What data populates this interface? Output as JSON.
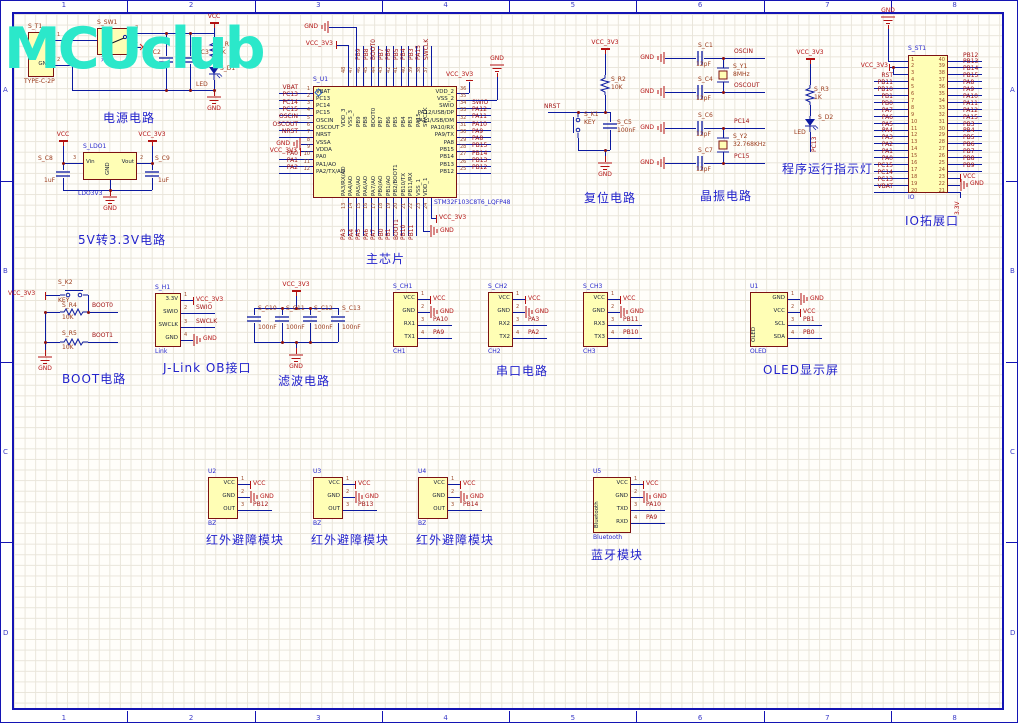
{
  "sheet": {
    "logo_text": "MCUclub",
    "zone_columns": [
      "1",
      "2",
      "3",
      "4",
      "5",
      "6",
      "7",
      "8"
    ],
    "zone_rows": [
      "A",
      "B",
      "C",
      "D"
    ]
  },
  "captions": {
    "power": "电源电路",
    "ldo": "5V转3.3V电路",
    "mcu": "主芯片",
    "reset": "复位电路",
    "crystal": "晶振电路",
    "led": "程序运行指示灯",
    "io": "IO拓展口",
    "boot": "BOOT电路",
    "jlink": "J-Link OB接口",
    "filter": "滤波电路",
    "serial": "串口电路",
    "oled": "OLED显示屏",
    "ir1": "红外避障模块",
    "ir2": "红外避障模块",
    "ir3": "红外避障模块",
    "bt": "蓝牙模块"
  },
  "power_nets": {
    "vcc": "VCC",
    "vcc3": "VCC_3V3",
    "gnd": "GND",
    "v33": "3.3V"
  },
  "net_labels": {
    "nrst": "NRST",
    "boot0": "BOOT0",
    "boot1": "BOOT1",
    "pc13": "PC13",
    "oscin": "OSCIN",
    "oscout": "OSCOUT",
    "pc14": "PC14",
    "pc15": "PC15"
  },
  "mcu": {
    "designator": "S_U1",
    "part": "STM32F103C8T6_LQFP48",
    "left": [
      [
        "1",
        "VBAT",
        "VBAT"
      ],
      [
        "2",
        "PC13",
        "PC13"
      ],
      [
        "3",
        "PC14",
        "PC14"
      ],
      [
        "4",
        "PC15",
        "PC15"
      ],
      [
        "5",
        "OSCIN",
        "OSCIN"
      ],
      [
        "6",
        "OSCOUT",
        "OSCOUT"
      ],
      [
        "7",
        "NRST",
        "NRST"
      ],
      [
        "8",
        "VSSA",
        "GND"
      ],
      [
        "9",
        "VDDA",
        "VCC_3V3"
      ],
      [
        "10",
        "PA0",
        "PA0"
      ],
      [
        "11",
        "PA1/AO",
        "PA1"
      ],
      [
        "12",
        "PA2/TX/AO",
        "PA2"
      ]
    ],
    "right": [
      [
        "36",
        "VDD_2",
        ""
      ],
      [
        "35",
        "VSS_2",
        ""
      ],
      [
        "34",
        "SWIO",
        "SWIO"
      ],
      [
        "33",
        "PA12/USB/DP",
        "PA12"
      ],
      [
        "32",
        "PA11/USB/DM",
        "PA11"
      ],
      [
        "31",
        "PA10/RX",
        "PA10"
      ],
      [
        "30",
        "PA9/TX",
        "PA9"
      ],
      [
        "29",
        "PA8",
        "PA8"
      ],
      [
        "28",
        "PB15",
        "PB15"
      ],
      [
        "27",
        "PB14",
        "PB14"
      ],
      [
        "26",
        "PB13",
        "PB13"
      ],
      [
        "25",
        "PB12",
        "PB12"
      ]
    ],
    "top": [
      [
        "48",
        "VDD_3",
        ""
      ],
      [
        "47",
        "VSS_3",
        ""
      ],
      [
        "46",
        "PB9",
        "PB9"
      ],
      [
        "45",
        "PB8",
        "PB8"
      ],
      [
        "44",
        "BOOT0",
        "BOOT0"
      ],
      [
        "43",
        "PB7",
        "PB7"
      ],
      [
        "42",
        "PB6",
        "PB6"
      ],
      [
        "41",
        "PB5",
        "PB5"
      ],
      [
        "40",
        "PB4",
        "PB4"
      ],
      [
        "39",
        "PB3",
        "PB3"
      ],
      [
        "38",
        "PA15",
        "PA15"
      ],
      [
        "37",
        "SWCLK",
        "SWCLK"
      ]
    ],
    "bottom": [
      [
        "13",
        "PA3/RX/AO",
        "PA3"
      ],
      [
        "14",
        "PA4/AO",
        "PA4"
      ],
      [
        "15",
        "PA5/AO",
        "PA5"
      ],
      [
        "16",
        "PA6/AO",
        "PA6"
      ],
      [
        "17",
        "PA7/AO",
        "PA7"
      ],
      [
        "18",
        "PB0/AO",
        "PB0"
      ],
      [
        "19",
        "PB1/AO",
        "PB1"
      ],
      [
        "20",
        "PB2/BOOT1",
        "BOOT1"
      ],
      [
        "21",
        "PB10/TX",
        "PB10"
      ],
      [
        "22",
        "PB11/RX",
        "PB11"
      ],
      [
        "23",
        "VSS_1",
        ""
      ],
      [
        "24",
        "VDD_1",
        ""
      ]
    ]
  },
  "io_header": {
    "designator": "S_ST1",
    "sub": "IO",
    "left_nums": [
      "1",
      "2",
      "3",
      "4",
      "5",
      "6",
      "7",
      "8",
      "9",
      "10",
      "11",
      "12",
      "13",
      "14",
      "15",
      "16",
      "17",
      "18",
      "19",
      "20"
    ],
    "right_nums": [
      "40",
      "39",
      "38",
      "37",
      "36",
      "35",
      "34",
      "33",
      "32",
      "31",
      "30",
      "29",
      "28",
      "27",
      "26",
      "25",
      "24",
      "23",
      "22",
      "21"
    ],
    "left_nets": [
      "",
      "",
      "",
      "RST",
      "PB11",
      "PB10",
      "PB1",
      "PB0",
      "PA7",
      "PA6",
      "PA5",
      "PA4",
      "PA3",
      "PA2",
      "PA1",
      "PA0",
      "PC15",
      "PC14",
      "PC13",
      "VBAT"
    ],
    "right_nets": [
      "PB12",
      "PB13",
      "PB14",
      "PB15",
      "PA8",
      "PA9",
      "PA10",
      "PA11",
      "PA12",
      "PA15",
      "PB3",
      "PB4",
      "PB5",
      "PB6",
      "PB7",
      "PB8",
      "PB9",
      "VCC",
      "GND",
      ""
    ]
  },
  "connectors": [
    {
      "id": "t1",
      "designator": "S_T1",
      "sub": "TYPE-C-2P",
      "pins": [
        [
          "1",
          "V",
          ""
        ],
        [
          "2",
          "GND",
          ""
        ]
      ]
    },
    {
      "id": "h1",
      "designator": "S_H1",
      "sub": "Link",
      "pins": [
        [
          "1",
          "3.3V",
          "VCC_3V3"
        ],
        [
          "2",
          "SWIO",
          "SWIO"
        ],
        [
          "3",
          "SWCLK",
          "SWCLK"
        ],
        [
          "4",
          "GND",
          "GND"
        ]
      ]
    },
    {
      "id": "ch1",
      "designator": "S_CH1",
      "sub": "CH1",
      "pins": [
        [
          "1",
          "VCC",
          "VCC"
        ],
        [
          "2",
          "GND",
          "GND"
        ],
        [
          "3",
          "RX1",
          "PA10"
        ],
        [
          "4",
          "TX1",
          "PA9"
        ]
      ]
    },
    {
      "id": "ch2",
      "designator": "S_CH2",
      "sub": "CH2",
      "pins": [
        [
          "1",
          "VCC",
          "VCC"
        ],
        [
          "2",
          "GND",
          "GND"
        ],
        [
          "3",
          "RX2",
          "PA3"
        ],
        [
          "4",
          "TX2",
          "PA2"
        ]
      ]
    },
    {
      "id": "ch3",
      "designator": "S_CH3",
      "sub": "CH3",
      "pins": [
        [
          "1",
          "VCC",
          "VCC"
        ],
        [
          "2",
          "GND",
          "GND"
        ],
        [
          "3",
          "RX3",
          "PB11"
        ],
        [
          "4",
          "TX3",
          "PB10"
        ]
      ]
    },
    {
      "id": "oled",
      "designator": "U1",
      "sub": "OLED",
      "vertical": "OLED",
      "pins": [
        [
          "1",
          "GND",
          "GND"
        ],
        [
          "2",
          "VCC",
          "VCC"
        ],
        [
          "3",
          "SCL",
          "PB1"
        ],
        [
          "4",
          "SDA",
          "PB0"
        ]
      ]
    },
    {
      "id": "ir1",
      "designator": "U2",
      "sub": "BZ",
      "pins": [
        [
          "1",
          "VCC",
          "VCC"
        ],
        [
          "2",
          "GND",
          "GND"
        ],
        [
          "3",
          "OUT",
          "PB12"
        ]
      ]
    },
    {
      "id": "ir2",
      "designator": "U3",
      "sub": "BZ",
      "pins": [
        [
          "1",
          "VCC",
          "VCC"
        ],
        [
          "2",
          "GND",
          "GND"
        ],
        [
          "3",
          "OUT",
          "PB13"
        ]
      ]
    },
    {
      "id": "ir3",
      "designator": "U4",
      "sub": "BZ",
      "pins": [
        [
          "1",
          "VCC",
          "VCC"
        ],
        [
          "2",
          "GND",
          "GND"
        ],
        [
          "3",
          "OUT",
          "PB14"
        ]
      ]
    },
    {
      "id": "bt",
      "designator": "U5",
      "sub": "Bluetooth",
      "vertical": "Bluetooth",
      "pins": [
        [
          "1",
          "VCC",
          "VCC"
        ],
        [
          "2",
          "GND",
          "GND"
        ],
        [
          "3",
          "TXD",
          "PA10"
        ],
        [
          "4",
          "RXD",
          "PA9"
        ]
      ]
    }
  ],
  "switch": {
    "designator": "S_SW1",
    "sub": "开关",
    "pin_top": "3",
    "pin_bottom": "1"
  },
  "ldo": {
    "designator": "S_LDO1",
    "sub": "LDO3V3",
    "pin_in": [
      "3",
      "Vin"
    ],
    "pin_out": [
      "2",
      "Vout"
    ],
    "center": "GND"
  },
  "discretes": {
    "c2": [
      "S_C2",
      ""
    ],
    "c3": [
      "S_C3",
      ""
    ],
    "r1": [
      "S_R1",
      "1K"
    ],
    "d1": [
      "S_D1",
      "LED"
    ],
    "c8": [
      "S_C8",
      "1uF"
    ],
    "c9": [
      "S_C9",
      "1uF"
    ],
    "r2": [
      "S_R2",
      "10K"
    ],
    "k1": [
      "S_K1",
      "KEY"
    ],
    "c5": [
      "S_C5",
      "100nF"
    ],
    "c1": [
      "S_C1",
      "12pF"
    ],
    "c4": [
      "S_C4",
      "12pF"
    ],
    "y1": [
      "S_Y1",
      "8MHz"
    ],
    "c6": [
      "S_C6",
      "12pF"
    ],
    "c7": [
      "S_C7",
      "12pF"
    ],
    "y2": [
      "S_Y2",
      "32.768KHz"
    ],
    "r3": [
      "S_R3",
      "1K"
    ],
    "d2": [
      "S_D2",
      "LED"
    ],
    "k2": [
      "S_K2",
      "KEY"
    ],
    "r4": [
      "S_R4",
      "10K"
    ],
    "r5": [
      "S_R5",
      "10K"
    ],
    "c10": [
      "S_C10",
      "100nF"
    ],
    "c11": [
      "S_C11",
      "100nF"
    ],
    "c12": [
      "S_C12",
      "100nF"
    ],
    "c13": [
      "S_C13",
      "100nF"
    ]
  }
}
